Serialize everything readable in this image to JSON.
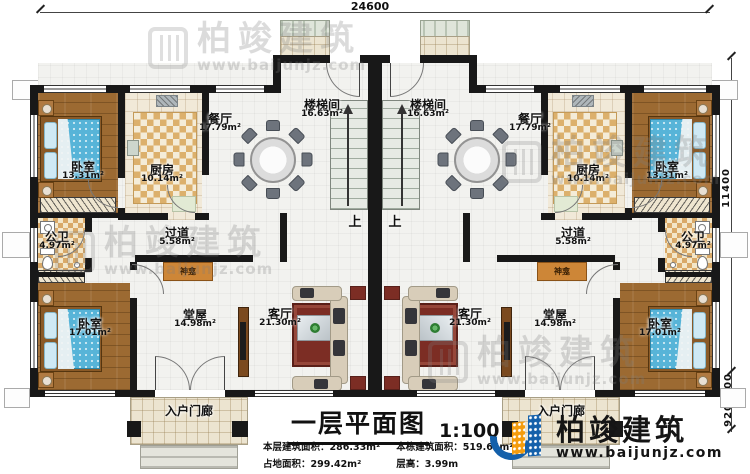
{
  "dims": {
    "width_top": "24600",
    "height_right": "11400",
    "porch_depth": "600",
    "step_depth": "920"
  },
  "rooms": {
    "bedroom_small": {
      "name": "卧室",
      "area": "13.31m²"
    },
    "kitchen": {
      "name": "厨房",
      "area": "10.14m²"
    },
    "dining": {
      "name": "餐厅",
      "area": "17.79m²"
    },
    "stairwell": {
      "name": "楼梯间",
      "area": "16.63m²"
    },
    "corridor": {
      "name": "过道",
      "area": "5.58m²"
    },
    "bathroom": {
      "name": "公卫",
      "area": "4.97m²"
    },
    "bedroom_large": {
      "name": "卧室",
      "area": "17.01m²"
    },
    "hall": {
      "name": "堂屋",
      "area": "14.98m²"
    },
    "living": {
      "name": "客厅",
      "area": "21.30m²"
    },
    "entry_porch": {
      "name": "入户门廊"
    },
    "shrine": {
      "name": "神龛"
    },
    "stairs_up": "上"
  },
  "titleblock": {
    "title": "一层平面图",
    "scale": "1:100",
    "stats": [
      {
        "label": "本层建筑面积：",
        "value": "286.33m²"
      },
      {
        "label": "本栋建筑面积：",
        "value": "519.64m²"
      },
      {
        "label": "占地面积：",
        "value": "299.42m²"
      },
      {
        "label": "层高：",
        "value": "3.99m"
      }
    ]
  },
  "brand": {
    "name": "柏竣建筑",
    "url": "www.baijunjz.com"
  },
  "watermark": {
    "name": "柏竣建筑",
    "url": "www.baijunjz.com"
  },
  "colors": {
    "wall": "#181818",
    "wood_floor": "#9c6a32",
    "tile_checker": "#dcb06c",
    "bed_blue": "#57b4d8",
    "brand_blue": "#1460aa",
    "brand_orange": "#f49c0d",
    "rug_red": "#7c2d24",
    "shrine_orange": "#cd8637"
  }
}
